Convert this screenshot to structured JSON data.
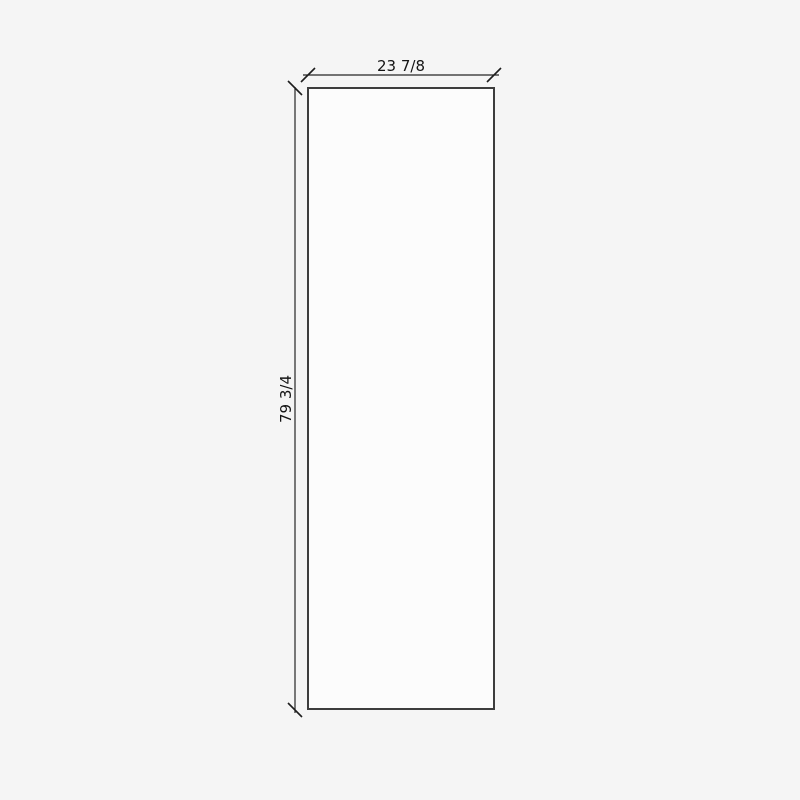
{
  "drawing": {
    "title": "panel-dimension-drawing",
    "panel": {
      "width_label": "23 7/8",
      "height_label": "79 3/4"
    },
    "colors": {
      "background": "#f5f5f5",
      "panel_fill": "#fcfcfc",
      "panel_stroke": "#3d3d3d",
      "dimension_line": "#262626",
      "label_text": "#141414"
    }
  }
}
